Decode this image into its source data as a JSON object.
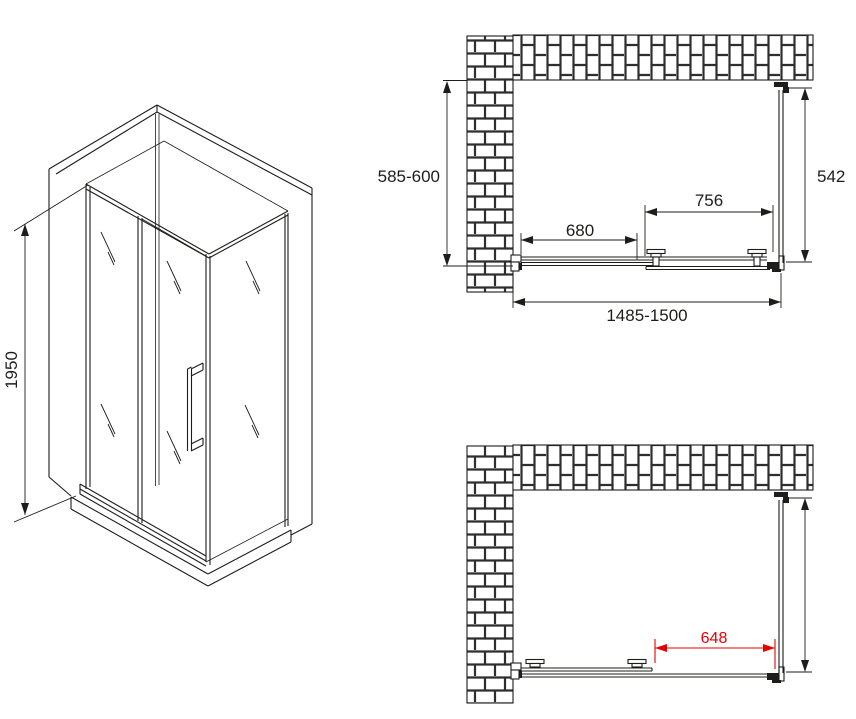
{
  "colors": {
    "line": "#1d1d1b",
    "brick_joint": "#2e2e2e",
    "dimension_red": "#e60000",
    "background": "#ffffff"
  },
  "isometric_view": {
    "height_mm": "1950"
  },
  "plan_view_top": {
    "wall_depth_mm": "585-600",
    "side_panel_mm": "542",
    "fixed_segment_mm": "680",
    "sliding_panel_mm": "756",
    "overall_width_mm": "1485-1500"
  },
  "plan_view_bottom": {
    "door_opening_mm": "648"
  }
}
